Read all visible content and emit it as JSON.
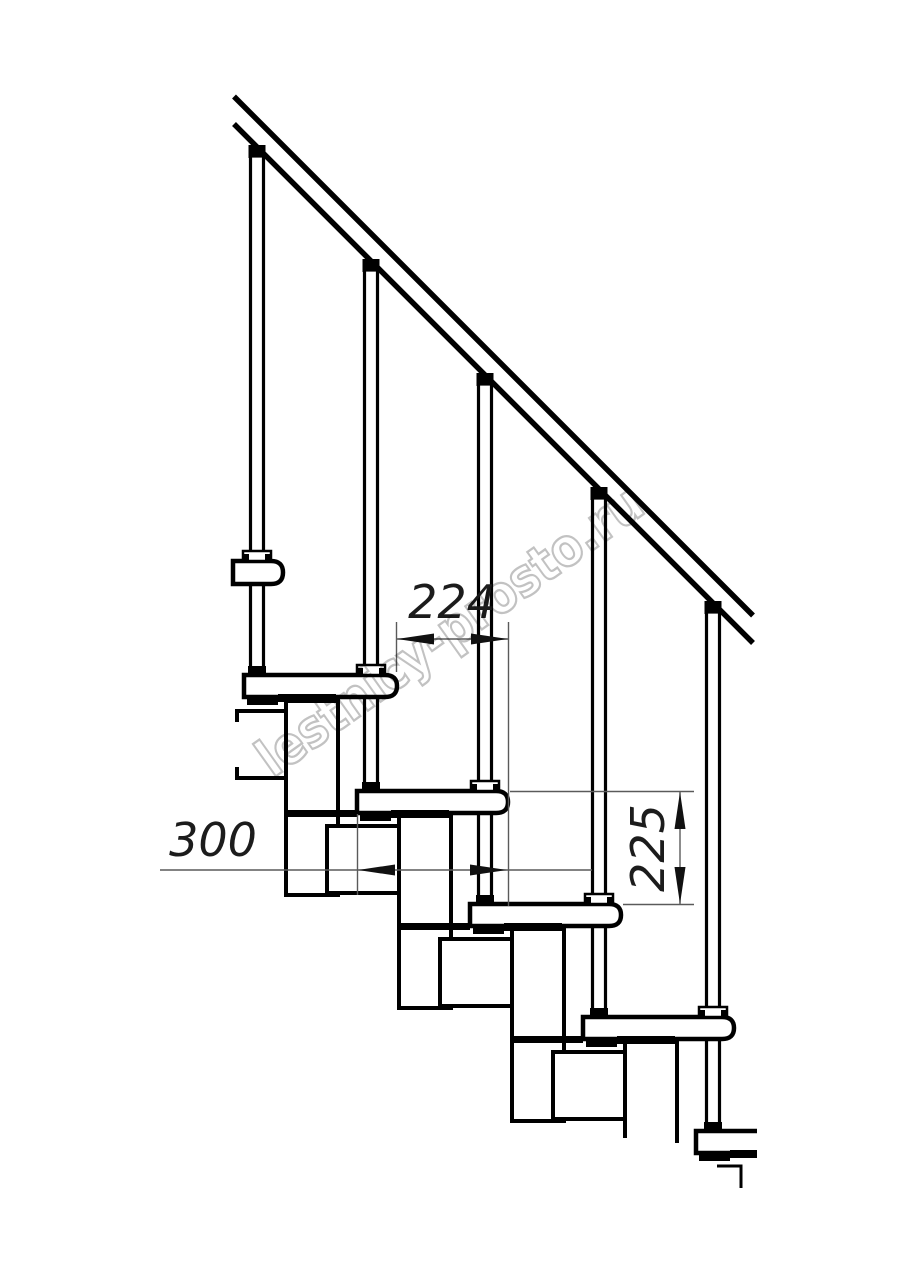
{
  "drawing": {
    "type": "staircase-side-view-technical-drawing",
    "background_color": "#ffffff",
    "line_color": "#000000",
    "dimension_line_color": "#5a5a5a",
    "dimension_text_color": "#1c1c1c",
    "watermark": {
      "text": "lestnicy-prosto.ru",
      "color": "#c2c2c2",
      "rotation_deg": -35.5
    },
    "dimensions": {
      "step_run": {
        "value": "224",
        "orientation": "horizontal"
      },
      "tread_depth": {
        "value": "300",
        "orientation": "horizontal"
      },
      "riser_height": {
        "value": "225",
        "orientation": "vertical"
      }
    },
    "elements": {
      "handrail": 1,
      "balusters": 5,
      "treads": 6,
      "stringer_modules": 7
    }
  }
}
